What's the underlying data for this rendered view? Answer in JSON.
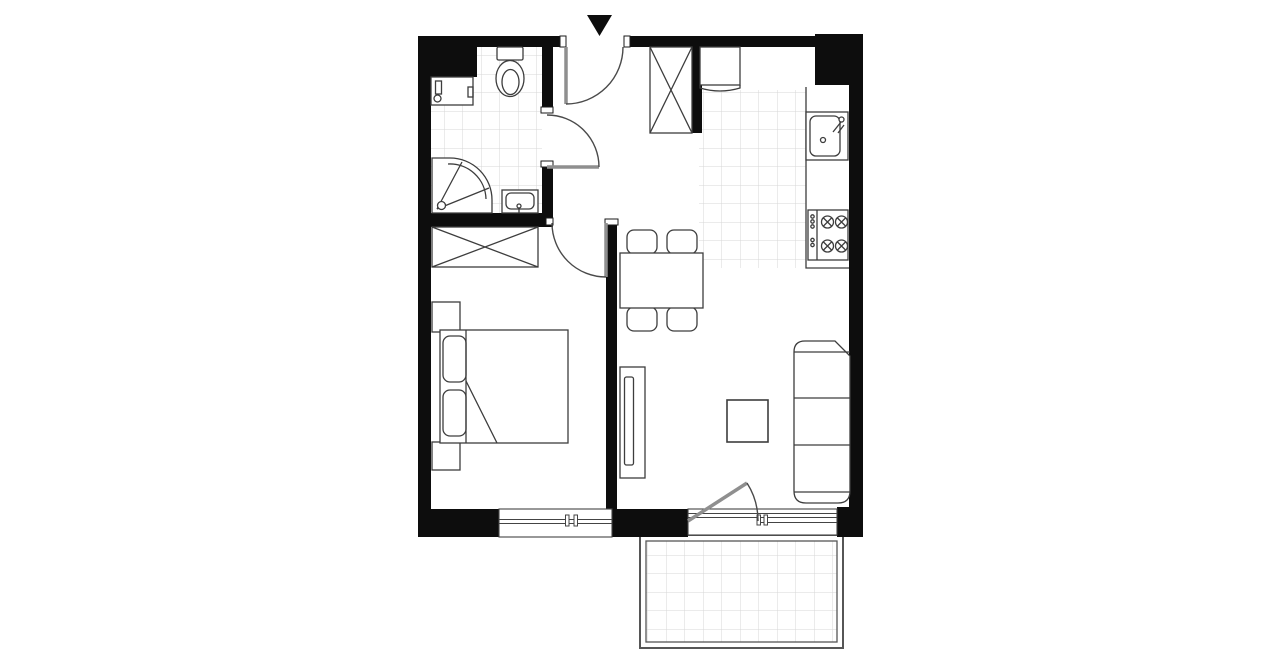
{
  "colors": {
    "background": "#ffffff",
    "wall": "#0d0d0d",
    "furniture": "#3d3d3d",
    "door": "#4a4a4a",
    "door_leaf": "#8f8f8f",
    "tile": "#d7d7d7",
    "balcony_rail": "#565656",
    "window_frame": "#444444"
  },
  "plan": {
    "kind": "apartment-floor-plan",
    "entrance_marker": "black-triangle-arrow-pointing-down",
    "rooms": [
      {
        "id": "bathroom",
        "position": "top-left",
        "floor": "tiled",
        "symbols": [
          "washing-machine",
          "toilet",
          "corner-shower",
          "washbasin",
          "door-to-hall"
        ]
      },
      {
        "id": "entrance-hall",
        "position": "top-center",
        "symbols": [
          "entrance-door",
          "built-in-wardrobe-crossed"
        ]
      },
      {
        "id": "bedroom",
        "position": "bottom-left",
        "symbols": [
          "wardrobe-crossed",
          "double-bed",
          "two-pillows",
          "nightstand-upper",
          "nightstand-lower",
          "window",
          "door-from-hall"
        ]
      },
      {
        "id": "living-room-with-kitchenette",
        "position": "right",
        "floor": "kitchen-area-tiled",
        "symbols": [
          "fridge",
          "kitchen-counter",
          "kitchen-sink",
          "stove-four-burners",
          "dining-table",
          "chair",
          "chair",
          "chair",
          "chair",
          "sofa-three-seat",
          "coffee-table",
          "tv-stand",
          "balcony-door",
          "window"
        ]
      },
      {
        "id": "balcony",
        "position": "bottom",
        "floor": "tiled",
        "symbols": [
          "railing"
        ]
      }
    ]
  }
}
